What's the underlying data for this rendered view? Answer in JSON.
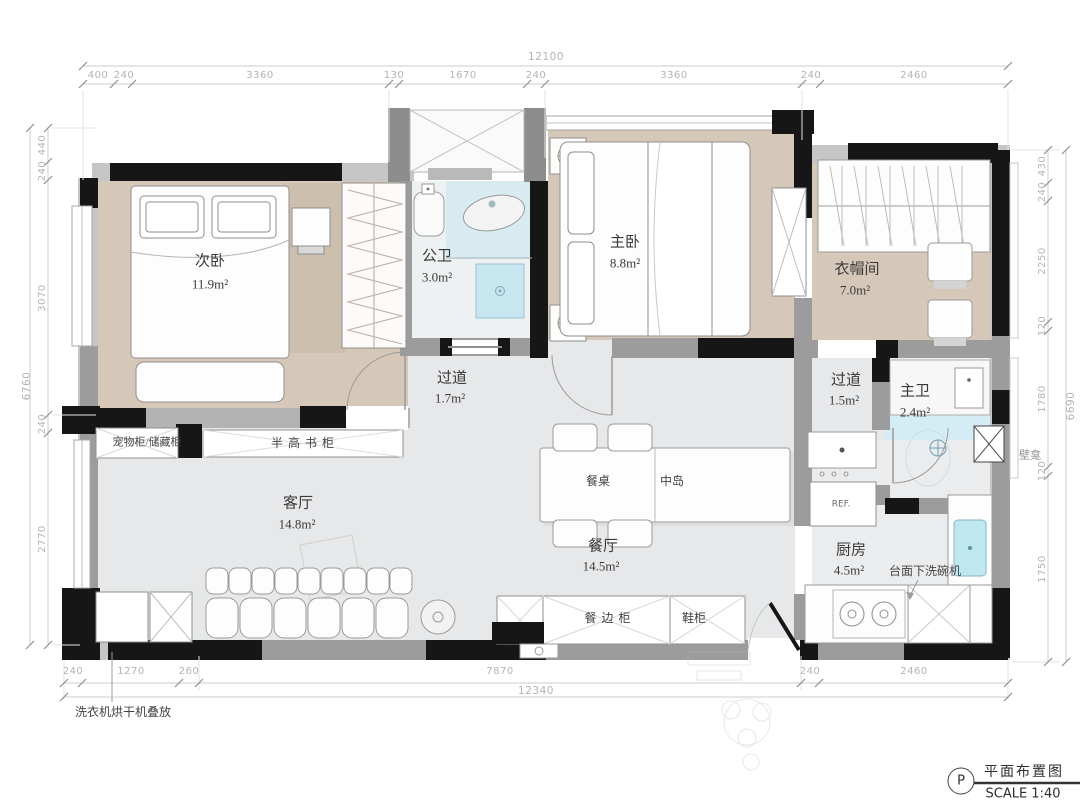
{
  "title_block": {
    "code": "P",
    "drawing_name": "平面布置图",
    "scale": "SCALE 1:40"
  },
  "rooms": {
    "second_bedroom": {
      "name": "次卧",
      "area": "11.9m²"
    },
    "guest_bath": {
      "name": "公卫",
      "area": "3.0m²"
    },
    "master_bedroom": {
      "name": "主卧",
      "area": "8.8m²"
    },
    "cloakroom": {
      "name": "衣帽间",
      "area": "7.0m²"
    },
    "corridor_a": {
      "name": "过道",
      "area": "1.7m²"
    },
    "corridor_b": {
      "name": "过道",
      "area": "1.5m²"
    },
    "master_bath": {
      "name": "主卫",
      "area": "2.4m²"
    },
    "living_room": {
      "name": "客厅",
      "area": "14.8m²"
    },
    "dining_room": {
      "name": "餐厅",
      "area": "14.5m²"
    },
    "kitchen": {
      "name": "厨房",
      "area": "4.5m²"
    }
  },
  "furniture": {
    "pet_cabinet": "宠物柜/储藏柜",
    "bookcase": "半高书柜",
    "dining_table": "餐桌",
    "island": "中岛",
    "sideboard": "餐边柜",
    "shoe_cabinet": "鞋柜",
    "fridge": "REF.",
    "dishwasher_note": "台面下洗碗机",
    "niche": "壁龛",
    "laundry_note": "洗衣机烘干机叠放"
  },
  "dimensions": {
    "top": {
      "overall": "12100",
      "segments": [
        "400",
        "240",
        "3360",
        "130",
        "1670",
        "240",
        "3360",
        "240",
        "2460"
      ]
    },
    "bottom": {
      "overall": "12340",
      "segments": [
        "240",
        "1270",
        "260",
        "7870",
        "240",
        "2460"
      ]
    },
    "left": {
      "overall": "6760",
      "segments": [
        "440",
        "240",
        "3070",
        "240",
        "2770"
      ]
    },
    "right": {
      "overall": "6690",
      "segments": [
        "430",
        "240",
        "2250",
        "120",
        "1780",
        "120",
        "1750"
      ]
    }
  }
}
